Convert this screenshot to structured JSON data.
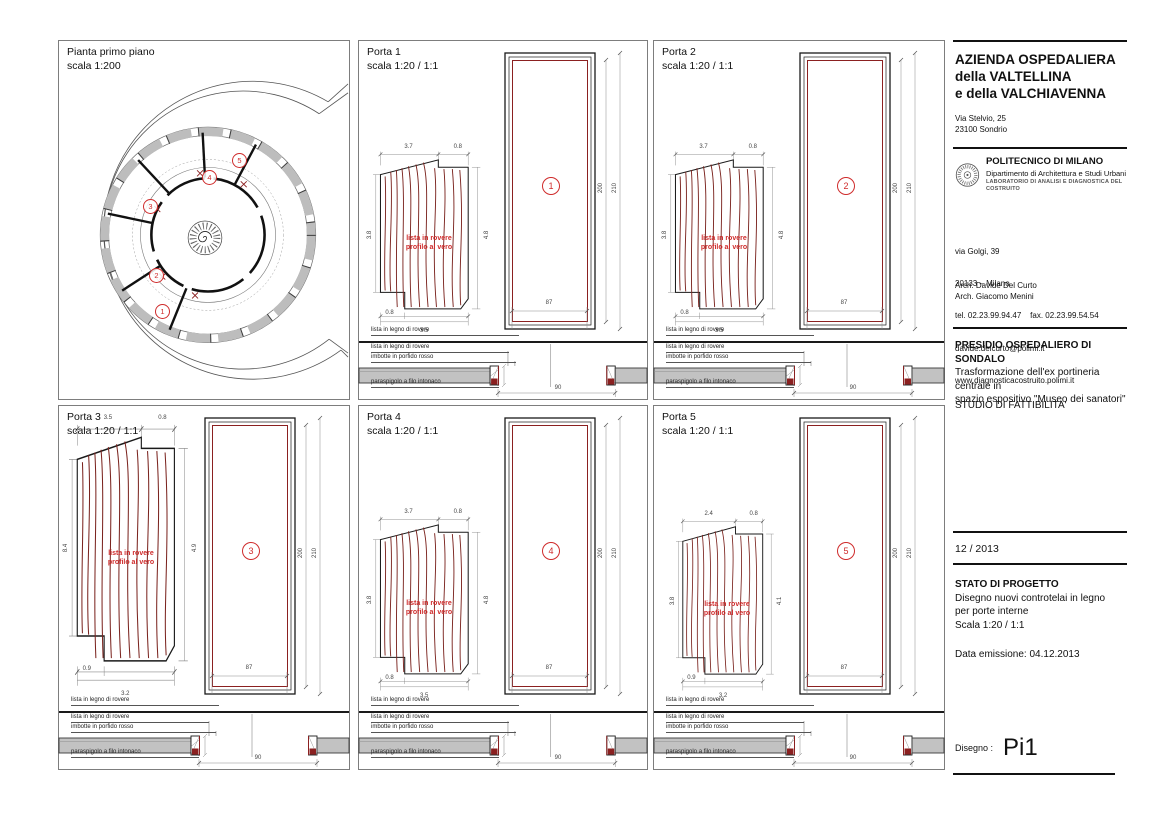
{
  "colors": {
    "accent_red": "#cf2b2b",
    "wood_grain_red": "#7b241f",
    "frame_red": "#8b2020",
    "wall_grey": "#c2c2c2"
  },
  "plan": {
    "title": "Pianta primo piano",
    "scale": "scala 1:200",
    "markers": [
      "1",
      "2",
      "3",
      "4",
      "5"
    ]
  },
  "door_common": {
    "profile_caption": "lista in legno di rovere",
    "section_label_1": "lista in legno di rovere",
    "section_label_2": "imbotte in porfido rosso",
    "section_label_3": "paraspigolo a filo intonaco",
    "profile_note_1": "lista in rovere",
    "profile_note_2": "profilo al vero"
  },
  "doors": [
    {
      "title": "Porta 1",
      "scale": "scala 1:20 / 1:1",
      "number": "1",
      "dims": {
        "top_a": "3.7",
        "top_b": "0.8",
        "right": "4.8",
        "left": "3.8",
        "bottom_a": "0.8",
        "bottom": "3.5",
        "width": "87",
        "height_inner": "200",
        "height_outer": "210",
        "sill": "90"
      }
    },
    {
      "title": "Porta 2",
      "scale": "scala 1:20 / 1:1",
      "number": "2",
      "dims": {
        "top_a": "3.7",
        "top_b": "0.8",
        "right": "4.8",
        "left": "3.8",
        "bottom_a": "0.8",
        "bottom": "3.5",
        "width": "87",
        "height_inner": "200",
        "height_outer": "210",
        "sill": "90"
      }
    },
    {
      "title": "Porta 3",
      "scale": "scala 1:20 / 1:1",
      "number": "3",
      "dims": {
        "top_a": "3.5",
        "top_b": "0.8",
        "right": "4.9",
        "left": "8.4",
        "bottom_a": "0.9",
        "bottom": "3.2",
        "width": "87",
        "height_inner": "200",
        "height_outer": "210",
        "sill": "90"
      }
    },
    {
      "title": "Porta 4",
      "scale": "scala 1:20 / 1:1",
      "number": "4",
      "dims": {
        "top_a": "3.7",
        "top_b": "0.8",
        "right": "4.8",
        "left": "3.8",
        "bottom_a": "0.8",
        "bottom": "3.5",
        "width": "87",
        "height_inner": "200",
        "height_outer": "210",
        "sill": "90"
      }
    },
    {
      "title": "Porta 5",
      "scale": "scala 1:20 / 1:1",
      "number": "5",
      "dims": {
        "top_a": "2.4",
        "top_b": "0.8",
        "right": "4.1",
        "left": "3.8",
        "bottom_a": "0.9",
        "bottom": "3.2",
        "width": "87",
        "height_inner": "200",
        "height_outer": "210",
        "sill": "90"
      }
    }
  ],
  "title_block": {
    "org_name_1": "AZIENDA OSPEDALIERA",
    "org_name_2": "della VALTELLINA",
    "org_name_3": "e della VALCHIAVENNA",
    "org_addr_1": "Via Stelvio, 25",
    "org_addr_2": "23100 Sondrio",
    "uni_name": "POLITECNICO DI MILANO",
    "uni_dept": "Dipartimento di Architettura e Studi Urbani",
    "uni_lab": "LABORATORIO DI ANALISI E DIAGNOSTICA DEL COSTRUITO",
    "uni_addr_1": "via Golgi, 39",
    "uni_addr_2": "20133 – Milano",
    "uni_addr_3": "tel. 02.23.99.94.47    fax. 02.23.99.54.54",
    "uni_addr_4": "davide.delcurto@polimi.it",
    "uni_addr_5": "www.diagnosticacostruito.polimi.it",
    "architect_1": "Arch. Davide Del Curto",
    "architect_2": "Arch. Giacomo Menini",
    "project_title": "PRESIDIO OSPEDALIERO DI SONDALO",
    "project_desc_1": "Trasformazione dell'ex portineria centrale in",
    "project_desc_2": "spazio espositivo \"Museo dei sanatori\"",
    "phase": "STUDIO DI FATTIBILITA'",
    "date_code": "12 / 2013",
    "status_title": "STATO DI PROGETTO",
    "status_desc_1": "Disegno nuovi controtelai in legno",
    "status_desc_2": "per porte interne",
    "status_desc_3": "Scala 1:20 / 1:1",
    "emission": "Data emissione: 04.12.2013",
    "drawing_label": "Disegno :",
    "drawing_code": "Pi1"
  }
}
